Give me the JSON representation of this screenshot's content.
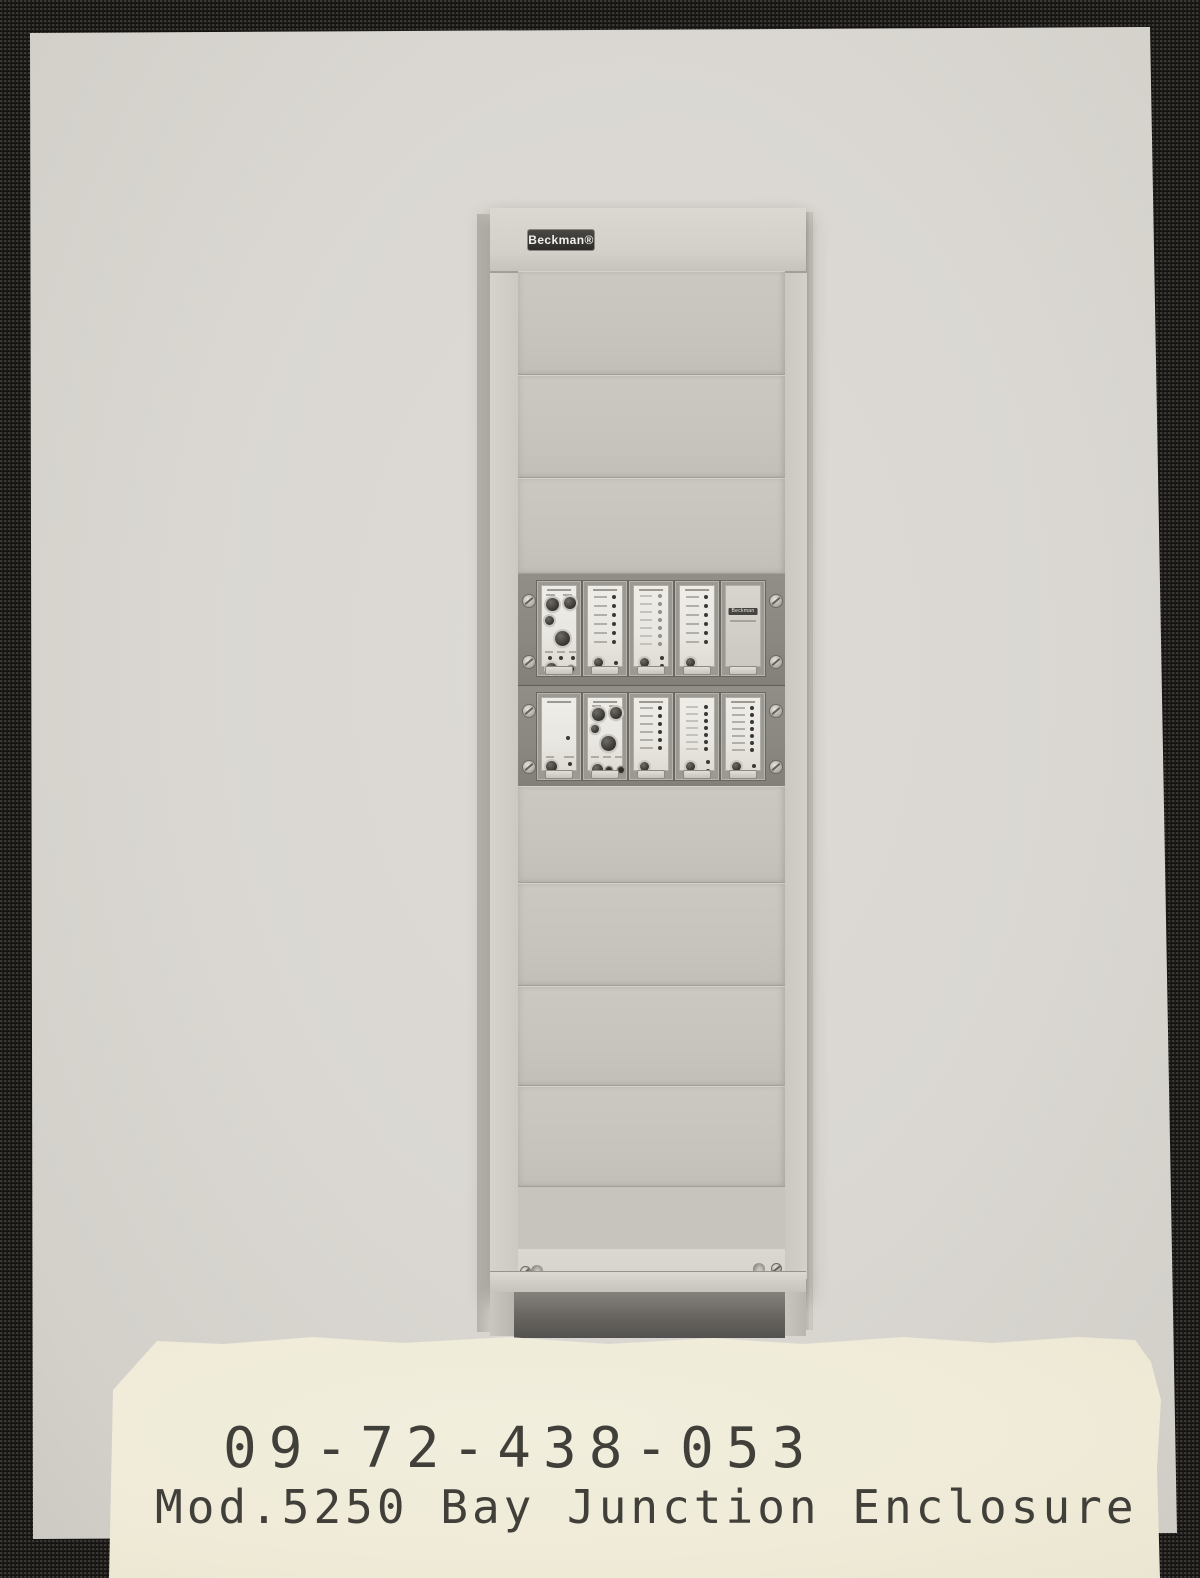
{
  "photo": {
    "rack": {
      "brand_badge": "Beckman®",
      "blank_module_badge": "Beckman"
    }
  },
  "caption": {
    "line1": "09-72-438-053",
    "line2": "Mod.5250 Bay Junction Enclosure"
  },
  "colors": {
    "mount_fabric": "#1b1917",
    "photo_paper": "#dad7d2",
    "rack_body": "#cfccc5",
    "bay_frame": "#8b8882",
    "label_paper": "#efebd8",
    "caption_text": "#413f39"
  }
}
